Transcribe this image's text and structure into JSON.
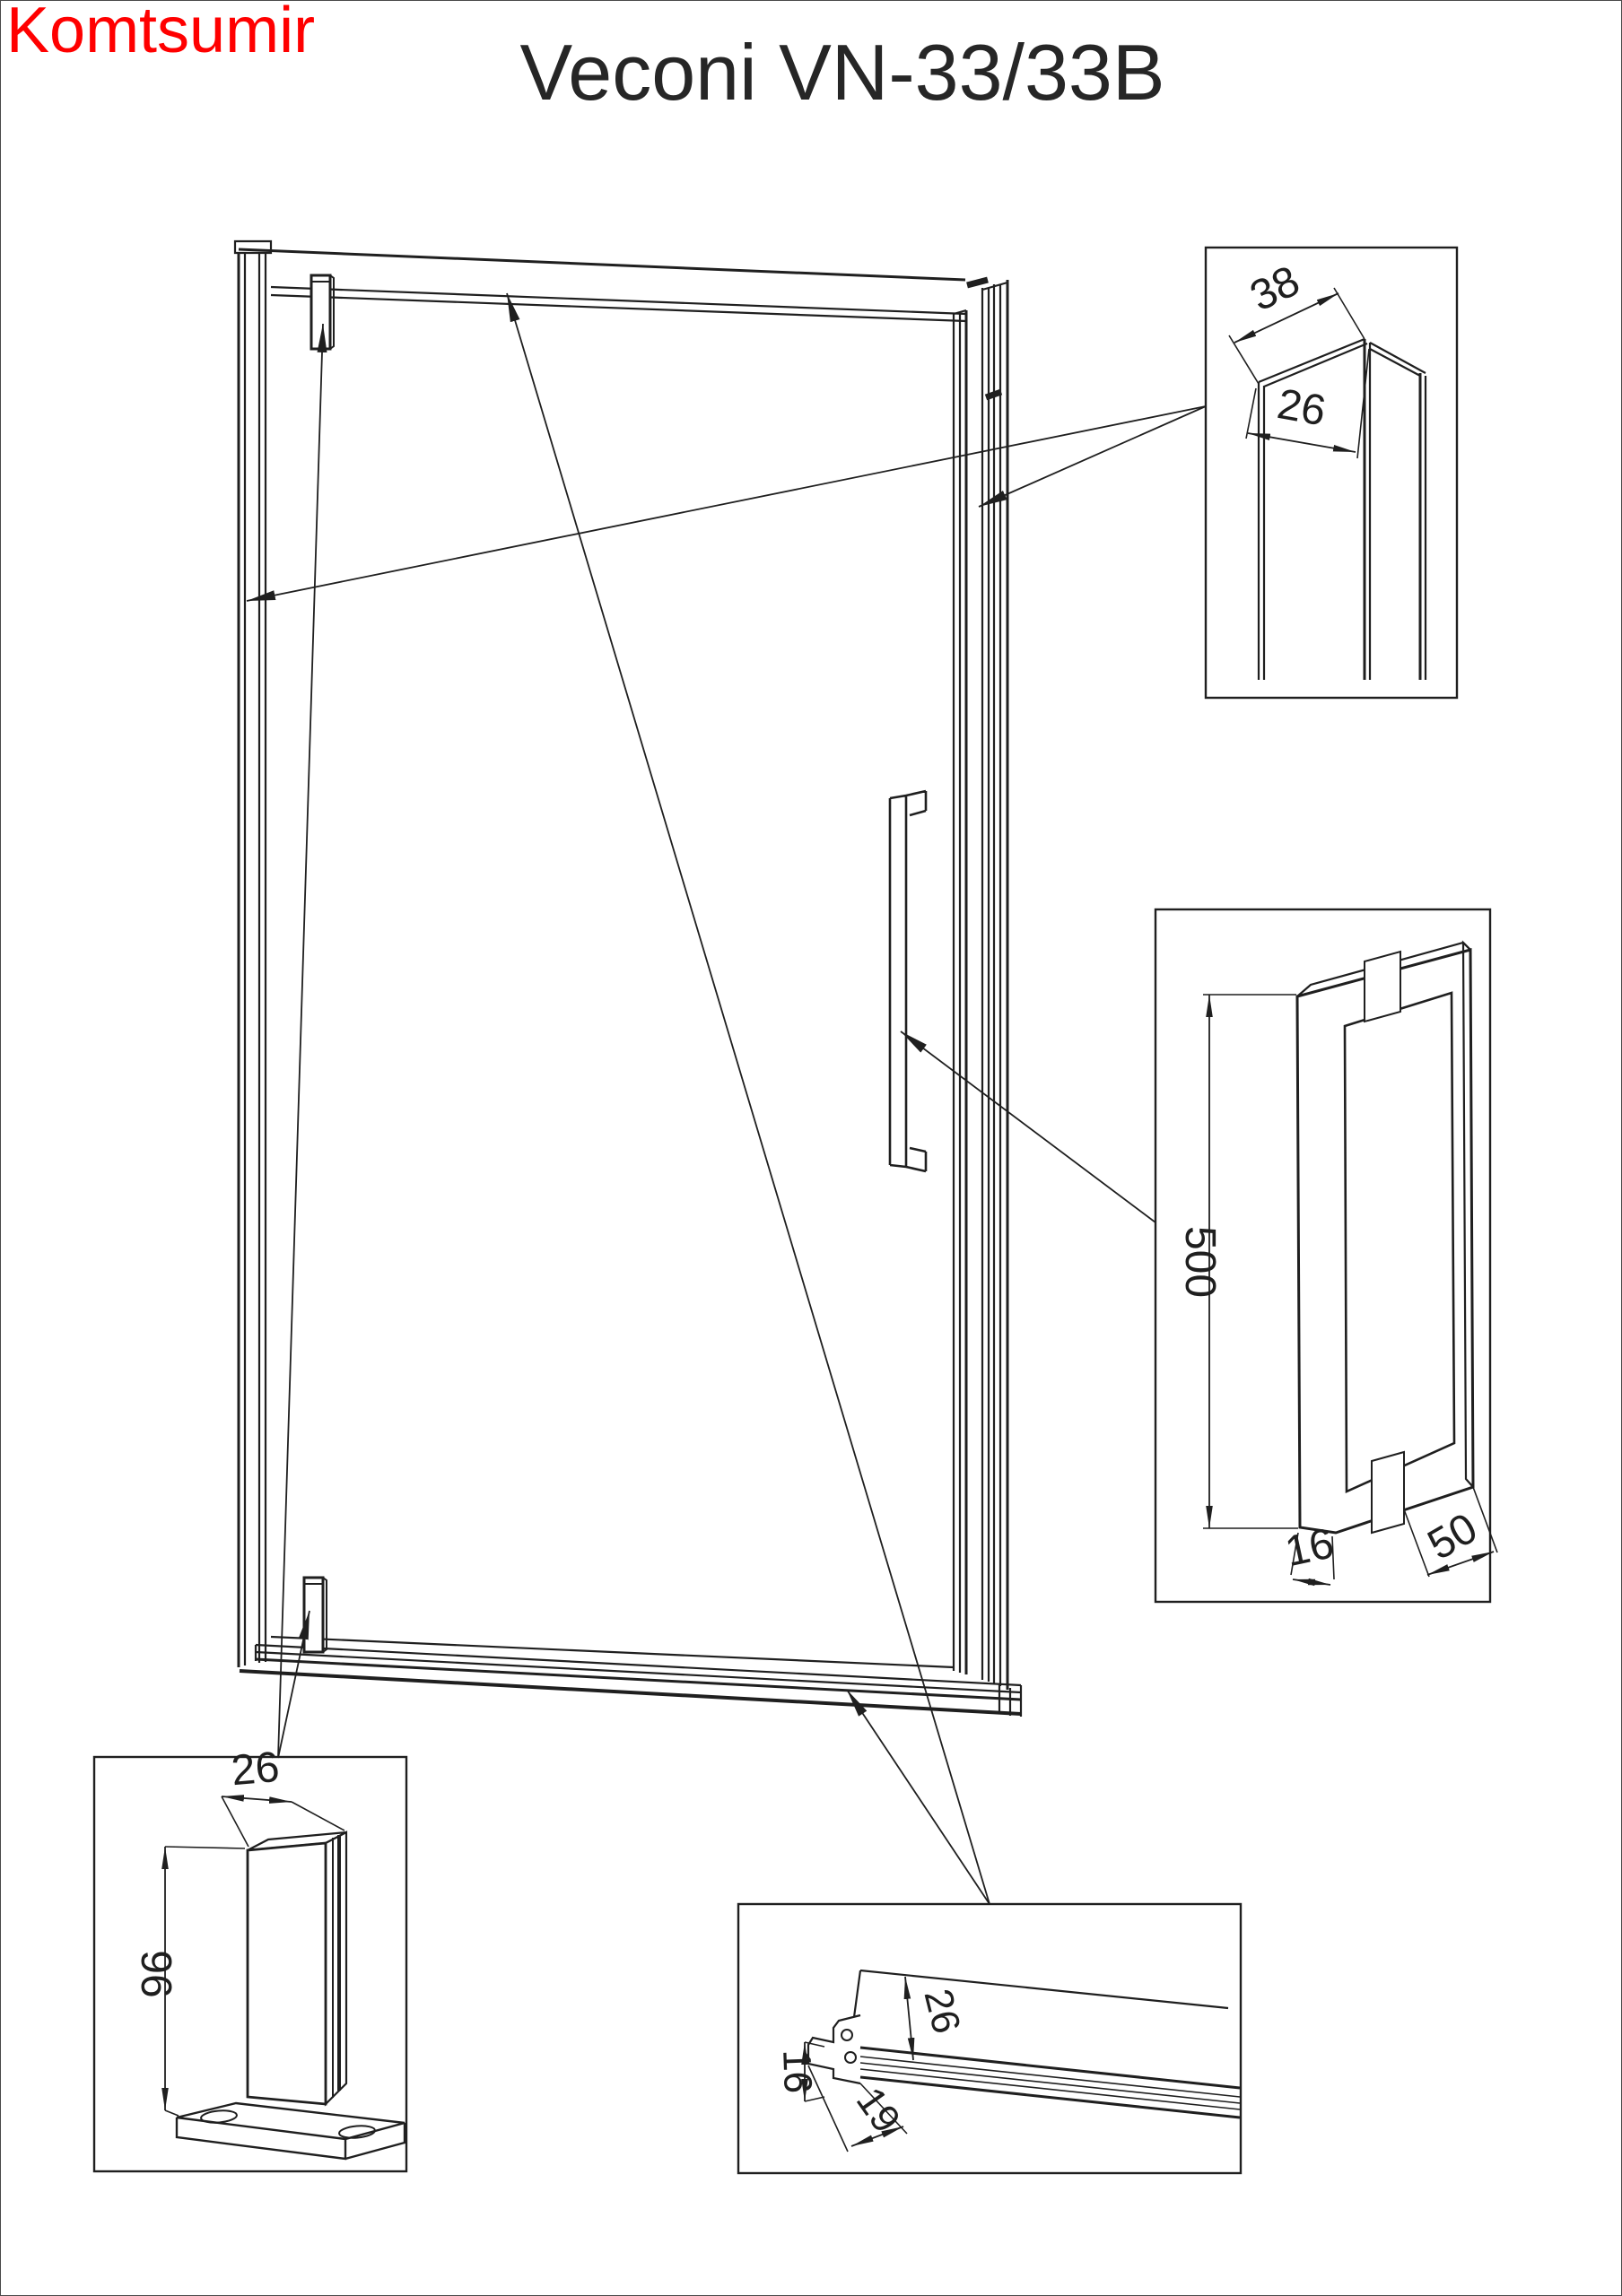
{
  "page": {
    "watermark": "Komtsumir",
    "watermark_color": "#ff0000",
    "title": "Veconi VN-33/33B",
    "line_color": "#1f1f1f",
    "background": "#ffffff"
  },
  "details": {
    "wall_profile": {
      "depth": "38",
      "width": "26"
    },
    "handle": {
      "height": "500",
      "thickness": "16",
      "depth": "50"
    },
    "pivot_hinge": {
      "width": "26",
      "height": "96"
    },
    "bottom_rail": {
      "glass_inset": "26",
      "height": "16",
      "depth": "19"
    }
  }
}
